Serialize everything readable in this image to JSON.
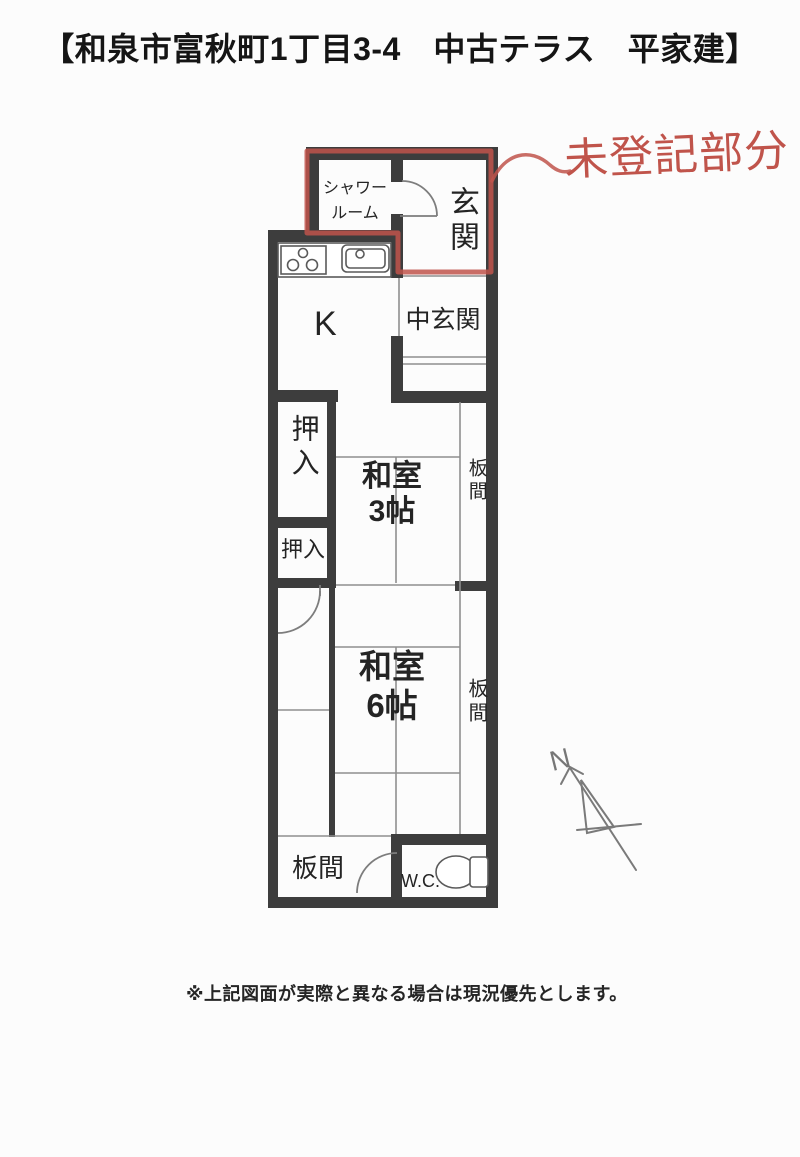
{
  "page": {
    "title": "【和泉市富秋町1丁目3-4　中古テラス　平家建】",
    "footnote": "※上記図面が実際と異なる場合は現況優先とします。"
  },
  "annotation": {
    "text": "未登記部分",
    "color": "#c0544b"
  },
  "compass": {
    "label": "N"
  },
  "plan": {
    "rooms": {
      "shower": {
        "line1": "シャワー",
        "line2": "ルーム"
      },
      "genkan": {
        "label": "玄関"
      },
      "kitchen": {
        "label": "K"
      },
      "naka_genkan": {
        "label": "中玄関"
      },
      "oshiire_upper": {
        "label": "押入"
      },
      "washitsu3": {
        "line1": "和室",
        "line2": "3帖"
      },
      "itanoma_upper": {
        "label": "板間"
      },
      "oshiire_lower": {
        "label": "押入"
      },
      "washitsu6": {
        "line1": "和室",
        "line2": "6帖"
      },
      "itanoma_middle": {
        "label": "板間"
      },
      "itanoma_bottom": {
        "label": "板間"
      },
      "wc": {
        "label": "W.C."
      }
    },
    "colors": {
      "wall": "#3d3d3d",
      "thin_line": "#8f8f8f",
      "annotation_red": "#c0544b"
    }
  }
}
